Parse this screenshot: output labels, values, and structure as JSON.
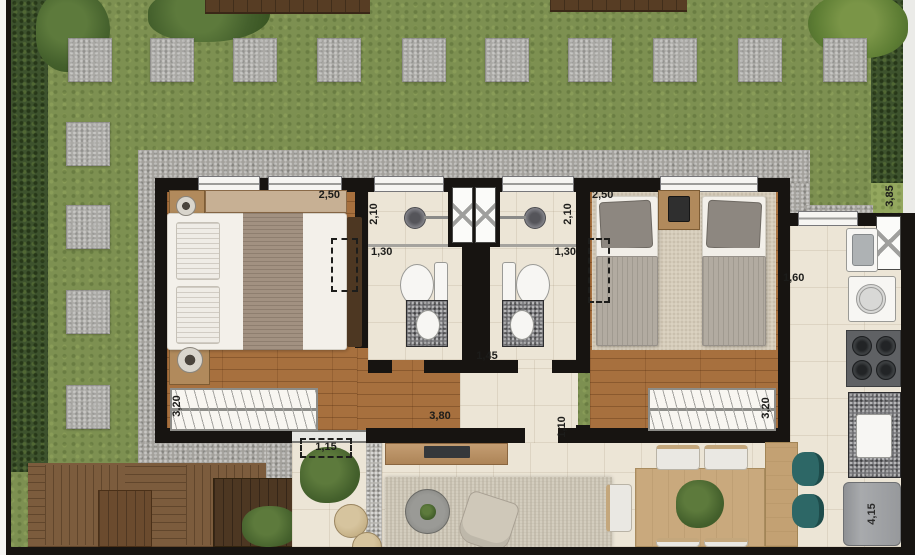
{
  "plan": {
    "kind": "floor-plan-top-view",
    "labels": {
      "bedroom1_width": "2,50",
      "bedroom1_length": "3,20",
      "bath1_shower": "2,10",
      "bath1_width": "1,30",
      "bath2_shower": "2,10",
      "bath2_width": "1,30",
      "bedroom2_width": "2,50",
      "bedroom2_length": "3,20",
      "garden_side": "3,85",
      "kitchen_width": "1,60",
      "hall_width": "1,45",
      "living_width": "3,80",
      "hall_depth": "1,10",
      "terrace_width": "1,15",
      "kitchen_length": "4,15"
    },
    "palette": {
      "wall": "#171411",
      "grass": "#7d9051",
      "hedge": "#3d522d",
      "stone_path": "#a3a19c",
      "deck_wood": "#7c5c3d",
      "floor_wood": "#a7703e",
      "floor_tile": "#ece5d6",
      "granite": "#717174",
      "teal_chair": "#2d6766",
      "dining_wood": "#c9a97d",
      "appliance_gray": "#9c9ea0",
      "rug": "#d8d2c3"
    }
  }
}
